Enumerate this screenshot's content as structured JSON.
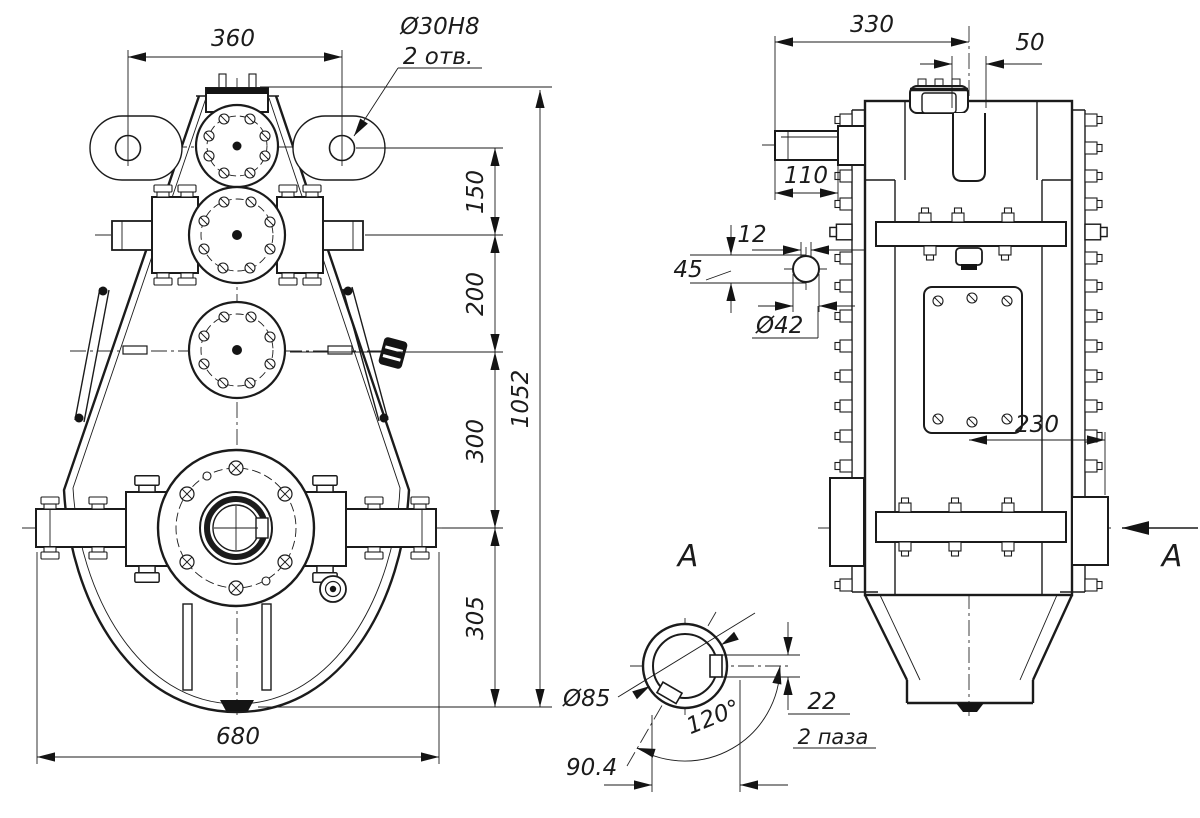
{
  "meta": {
    "background": "#ffffff",
    "ink": "#1b1b1b",
    "drawing_type": "gear reducer assembly drawing"
  },
  "front_view": {
    "dim_width_top": "360",
    "dim_hole": "Ø30H8",
    "dim_hole_note": "2 отв.",
    "dim_h1": "150",
    "dim_h2": "200",
    "dim_h3": "300",
    "dim_h4": "305",
    "dim_total_height": "1052",
    "dim_width_bottom": "680"
  },
  "side_view": {
    "dim_depth": "330",
    "dim_top_offset": "50",
    "dim_shaft_length": "110",
    "dim_key_width": "12",
    "dim_key_height": "45",
    "dim_shaft_dia": "Ø42",
    "dim_lower_offset": "230",
    "view_arrow_label": "А"
  },
  "section_a": {
    "title": "А",
    "dim_dia": "Ø85",
    "dim_angle": "120°",
    "dim_slot": "22",
    "dim_slot_note": "2 паза",
    "dim_across": "90.4"
  }
}
